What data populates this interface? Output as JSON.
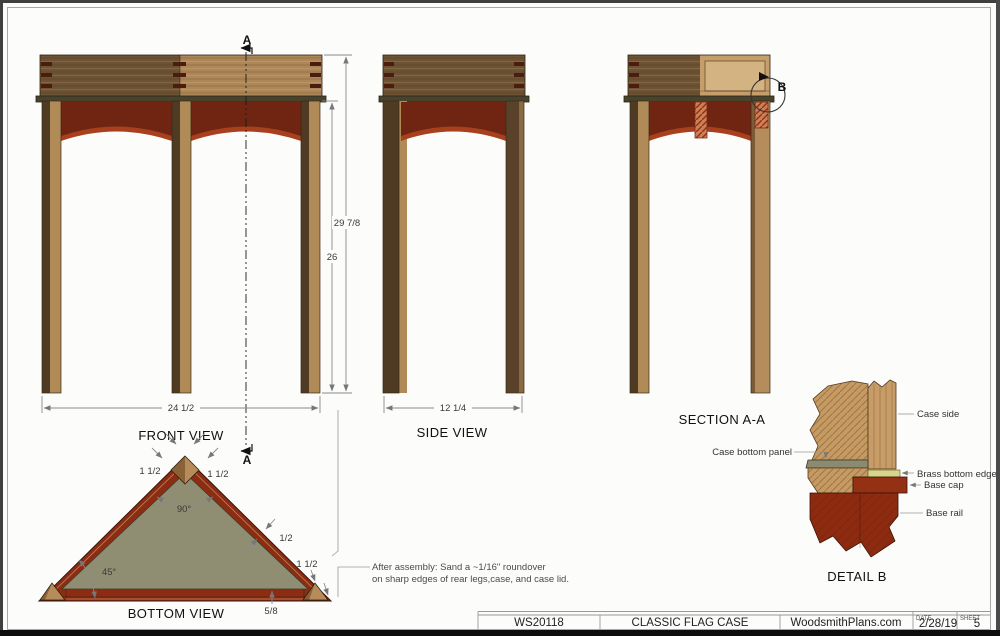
{
  "sheet": {
    "title_block": {
      "plan_number": "WS20118",
      "plan_title": "CLASSIC FLAG CASE",
      "publisher": "WoodsmithPlans.com",
      "date_label": "DATE",
      "date_value": "2/28/19",
      "sheet_label": "SHEET",
      "sheet_value": "5"
    },
    "note": {
      "line1": "After assembly: Sand a ~1/16\" roundover",
      "line2": "on sharp edges of rear legs,case, and case lid."
    }
  },
  "views": {
    "front": {
      "label": "FRONT VIEW",
      "section_marker": "A",
      "dim_total_height": "29 7/8",
      "dim_leg_height": "26",
      "dim_width": "24 1/2"
    },
    "side": {
      "label": "SIDE VIEW",
      "dim_depth": "12 1/4"
    },
    "section_aa": {
      "label": "SECTION A-A",
      "detail_marker": "B"
    },
    "bottom": {
      "label": "BOTTOM VIEW",
      "dim_leg_front_left": "1 1/2",
      "dim_leg_front_right": "1 1/2",
      "dim_apex_angle": "90°",
      "dim_corner_angle": "45°",
      "dim_rail_offset": "1/2",
      "dim_leg_rear": "1 1/2",
      "dim_rail_height": "5/8"
    },
    "detail_b": {
      "label": "DETAIL  B",
      "callout_case_side": "Case side",
      "callout_case_bottom_panel": "Case bottom panel",
      "callout_brass_bottom_edge": "Brass bottom edge",
      "callout_base_cap": "Base cap",
      "callout_base_rail": "Base rail"
    }
  },
  "colors": {
    "wood_dark": "#6d5334",
    "wood_light": "#ad8758",
    "wood_pale": "#c79c66",
    "leg_dark": "#4f3a23",
    "leg_light": "#b08a57",
    "apron_dark": "#6f2511",
    "apron_light": "#a8401e",
    "base_red": "#8c2d13",
    "panel_olive": "#8f8e73",
    "brass": "#d9d48c",
    "joint_pin": "#4c1d0e"
  }
}
